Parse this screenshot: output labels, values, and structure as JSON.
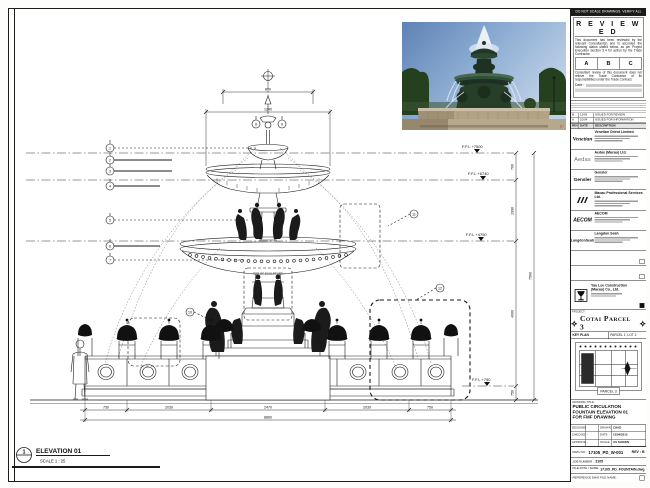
{
  "sheet": {
    "top_note": "DO NOT SCALE DRAWINGS. VERIFY ALL DIMENSIONS ON SITE."
  },
  "stamp": {
    "title": "R E V I E W E D",
    "body1": "This document has been reviewed by the relevant Consultant(s) and is accorded the following status stated below, as per Project Execution Section 5.4 for action by the Trade Contractor.",
    "options": [
      "A",
      "B",
      "C"
    ],
    "body2": "Consultant review of this document does not relieve the Trade Contractor of its responsibilities under the Trade Contract.",
    "date_label": "Date :"
  },
  "revision_table": {
    "header": [
      "REV",
      "DATE",
      "DESCRIPTION"
    ],
    "rows": [
      {
        "rev": "B",
        "date": "12/05",
        "description": "ISSUED FOR REVIEW"
      },
      {
        "rev": "A",
        "date": "10/04",
        "description": "ISSUED FOR INFORMATION"
      }
    ]
  },
  "consultants": [
    {
      "logo_text": "Venetian",
      "name": "Venetian Orient Limited"
    },
    {
      "logo_text": "Aedas",
      "name": "Aedas (Macau) Ltd."
    },
    {
      "logo_text": "Gensler",
      "name": "Gensler"
    },
    {
      "logo_text": "",
      "name": "Macau Professional Services Ltd."
    },
    {
      "logo_text": "AECOM",
      "name": "AECOM"
    },
    {
      "logo_text": "LangdonSeah",
      "name": "Langdon Seah"
    }
  ],
  "contractor": {
    "name_line1": "Yau Lee Construction",
    "name_line2": "(Macau) Co., Ltd."
  },
  "project": {
    "label": "PROJECT :",
    "title": "Cotai Parcel 3"
  },
  "key_plan": {
    "label": "KEY PLAN",
    "sub": "PARCEL 1, LOT 2",
    "tag": "PARCEL 3"
  },
  "drawing_title": {
    "label": "DRAWING TITLE :",
    "lines": [
      "PUBLIC CIRCULATION",
      "FOUNTAIN ELEVATION 01",
      "FOR FMF DRAWING"
    ]
  },
  "info_table": {
    "designed_label": "DESIGNED",
    "designed_value": "",
    "drawn_label": "DRAWN",
    "drawn_value": "CHAD",
    "checked_label": "CHECKED",
    "checked_value": "-",
    "date_label": "DATE",
    "date_value": "12/04/2015",
    "approved_label": "APPROVED",
    "approved_value": "-",
    "scale_label": "SCALE",
    "scale_value": "AS SHOWN"
  },
  "dwg": {
    "label": "DWG NO :",
    "value": "17105_PD_W-001",
    "rev": "REV : B"
  },
  "job": {
    "label": "JOB NUMBER :",
    "value": "3105"
  },
  "file": {
    "label": "FILE PATH / NAME :",
    "value": "17105_PD_FOUNTAIN.dwg"
  },
  "reference": {
    "label": "REFERENCE DWG FILE NAME :"
  },
  "elevation_label": {
    "number": "1",
    "title": "ELEVATION 01",
    "scale": "SCALE 1 : 25"
  },
  "levels": [
    "F.F.L +7500",
    "F.F.L +6740",
    "F.F.L +4750",
    "F.F.L +750"
  ],
  "dims": {
    "top": "890",
    "upper": "1240",
    "right_chain": [
      "760",
      "1990",
      "4000",
      "750"
    ],
    "right_total": "7500",
    "bottom": [
      "750",
      "2030",
      "2470",
      "2030",
      "750"
    ],
    "bottom_total": "8860"
  },
  "keynotes": [
    "1",
    "2",
    "3",
    "4",
    "5",
    "6",
    "7",
    "8",
    "9",
    "10",
    "11",
    "12"
  ],
  "notes": {
    "sculpture": "TOP OF SCULPTURE"
  },
  "photo": {
    "credit": "©"
  }
}
